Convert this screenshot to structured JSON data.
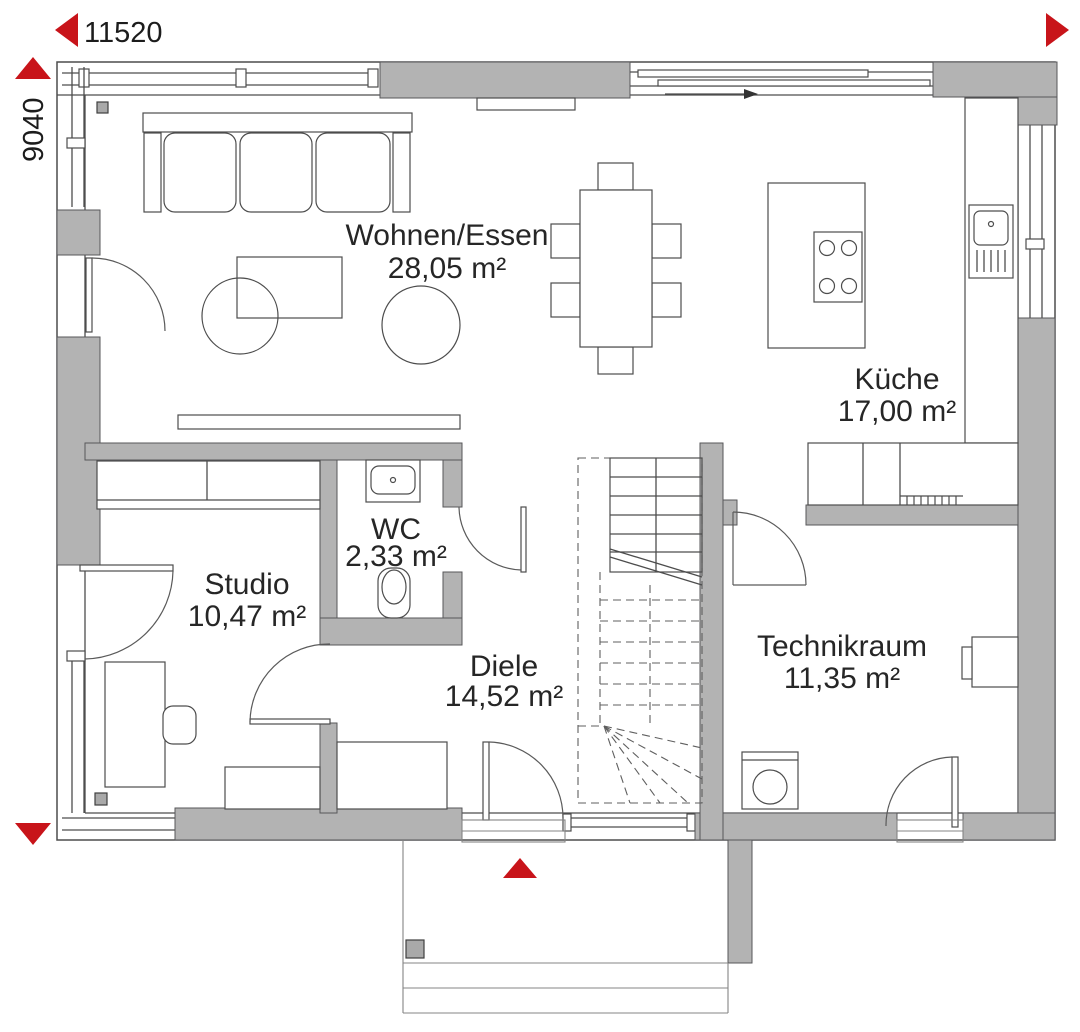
{
  "dimensions": {
    "width_label": "11520",
    "height_label": "9040"
  },
  "rooms": [
    {
      "name": "Wohnen/Essen",
      "area": "28,05 m²"
    },
    {
      "name": "Küche",
      "area": "17,00 m²"
    },
    {
      "name": "WC",
      "area": "2,33 m²"
    },
    {
      "name": "Studio",
      "area": "10,47 m²"
    },
    {
      "name": "Diele",
      "area": "14,52 m²"
    },
    {
      "name": "Technikraum",
      "area": "11,35 m²"
    }
  ],
  "colors": {
    "wall": "#b3b3b3",
    "accent": "#c8141a",
    "line": "#4d4d4d"
  }
}
